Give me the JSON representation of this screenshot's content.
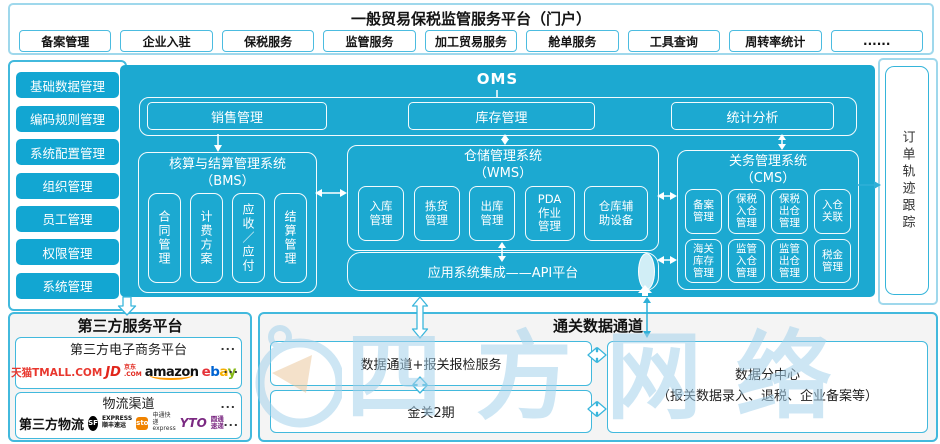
{
  "colors": {
    "main_cyan": "#1ca9d1",
    "button_cyan": "#12a6d2",
    "border_cyan": "#42b9dd",
    "border_light_cyan": "#9fd8ec",
    "arrow_cyan": "#2fb0d8",
    "watermark_blue": "#a5d2ec",
    "tmall_red": "#e8362d",
    "jd_red": "#e1251b",
    "amazon_orange": "#ff9900",
    "sto_orange": "#f08300",
    "yto_purple": "#7b2982"
  },
  "portal": {
    "title": "一般贸易保税监管服务平台（门户）",
    "tabs": [
      "备案管理",
      "企业入驻",
      "保税服务",
      "监管服务",
      "加工贸易服务",
      "舱单服务",
      "工具查询",
      "周转率统计",
      "......"
    ]
  },
  "sidebar": {
    "items": [
      "基础数据管理",
      "编码规则管理",
      "系统配置管理",
      "组织管理",
      "员工管理",
      "权限管理",
      "系统管理"
    ]
  },
  "oms": {
    "title": "OMS",
    "top_modules": [
      "销售管理",
      "库存管理",
      "统计分析"
    ],
    "bms": {
      "title": "核算与结算管理系统\n（BMS）",
      "items": [
        "合同管理",
        "计费方案",
        "应收／应付",
        "结算管理"
      ]
    },
    "wms": {
      "title": "仓储管理系统\n（WMS）",
      "items": [
        "入库\n管理",
        "拣货\n管理",
        "出库\n管理",
        "PDA\n作业\n管理",
        "仓库辅\n助设备"
      ]
    },
    "cms": {
      "title": "关务管理系统\n（CMS）",
      "row1": [
        "备案\n管理",
        "保税\n入仓\n管理",
        "保税\n出仓\n管理",
        "入仓\n关联"
      ],
      "row2": [
        "海关\n库存\n管理",
        "监管\n入仓\n管理",
        "监管\n出仓\n管理",
        "税金\n管理"
      ]
    },
    "api_platform": "应用系统集成——API平台"
  },
  "order_tracking": {
    "label": "订单轨迹跟踪"
  },
  "third_party": {
    "title": "第三方服务平台",
    "ecommerce": {
      "label": "第三方电子商务平台",
      "more_top": "...",
      "more_bottom": "...",
      "tmall": "天猫TMALL.COM",
      "jd": "JD",
      "jd_stack": "京东\n.COM",
      "amazon": "amazon",
      "ebay": [
        "e",
        "b",
        "a",
        "y"
      ]
    },
    "logistics": {
      "label": "物流渠道",
      "more_top": "...",
      "more_bottom": "...",
      "prefix": "第三方物流",
      "sf_badge": "SF",
      "sf_stack": "EXPRESS\n顺丰速运",
      "sto_badge": "sto",
      "sto_stack": "申通快递\nexpress",
      "yto_badge": "YTO",
      "yto_stack": "圆通速递"
    }
  },
  "customs": {
    "title": "通关数据通道",
    "channel": "数据通道+报关报检服务",
    "golden_gate": "金关2期",
    "data_center": "数据分中心\n（报关数据录入、退税、企业备案等）"
  },
  "watermark": {
    "text": "四方网络"
  }
}
